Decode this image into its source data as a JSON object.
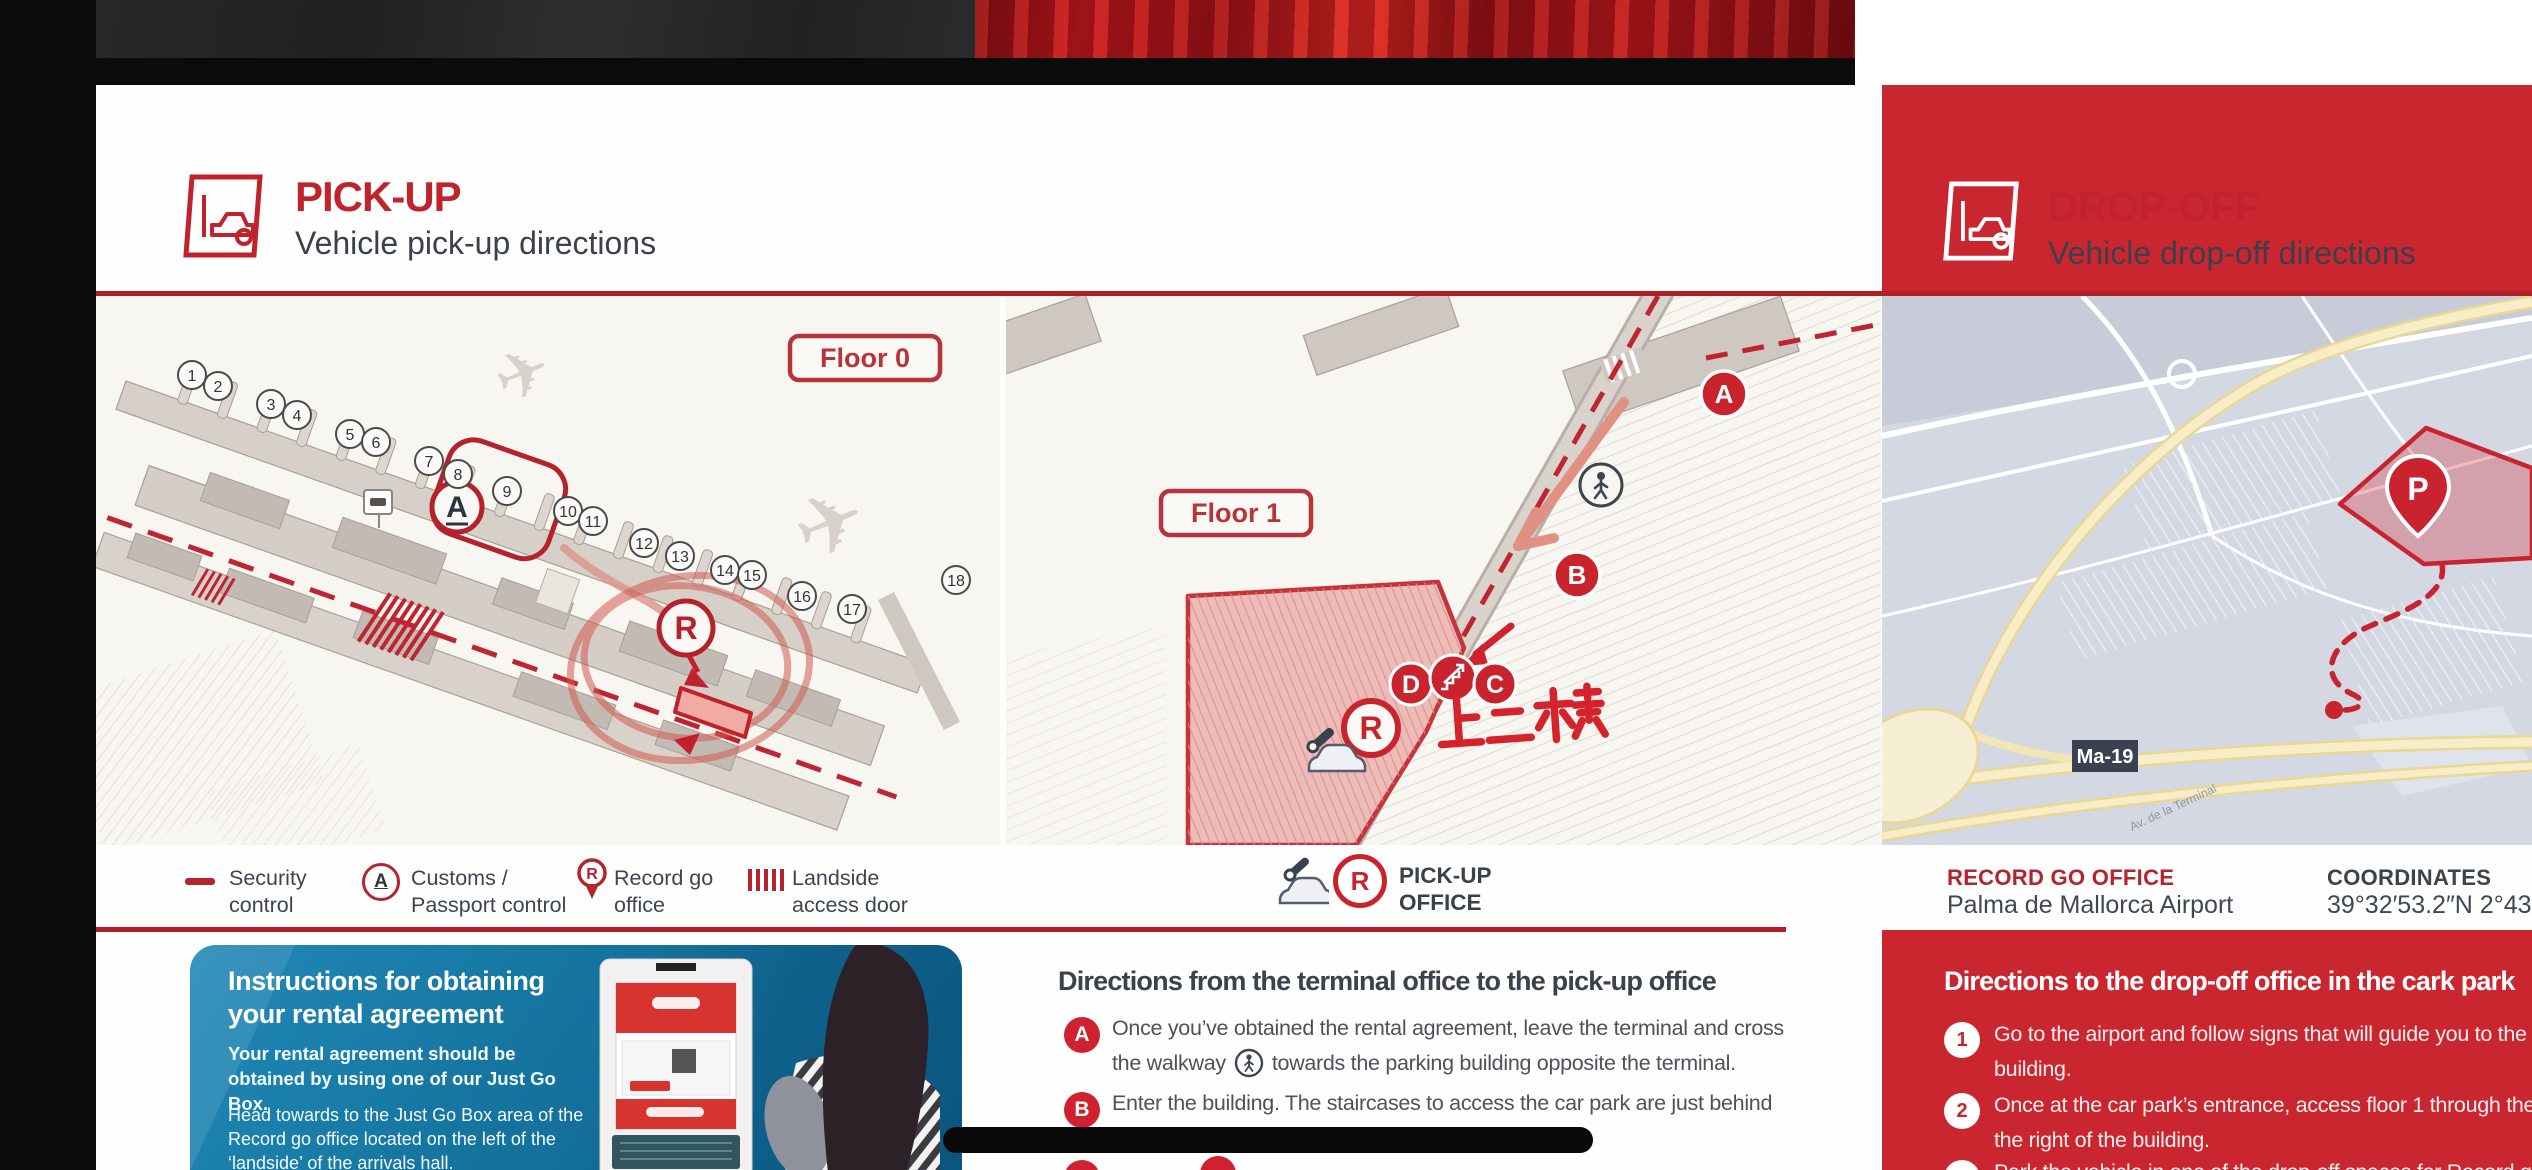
{
  "colors": {
    "brand_red": "#ca2630",
    "rule_red": "#ae1f26",
    "dark_text": "#3b424d",
    "legend_red": "#b5242c",
    "blue_box": "#15749f",
    "map_paper": "#f8f6f1",
    "street_map_bg": "#d4d8e2"
  },
  "pickup": {
    "header": {
      "title": "PICK-UP",
      "subtitle": "Vehicle pick-up directions"
    },
    "floor0": {
      "badge": "Floor 0",
      "gates": [
        "1",
        "2",
        "3",
        "4",
        "5",
        "6",
        "7",
        "8",
        "9",
        "10",
        "11",
        "12",
        "13",
        "14",
        "15",
        "16",
        "17",
        "18"
      ],
      "marker_a": "A",
      "marker_r": "R"
    },
    "floor1": {
      "badge": "Floor 1",
      "marker_a": "A",
      "marker_b": "B",
      "marker_c": "C",
      "marker_d": "D",
      "marker_r": "R",
      "note_cn": "上二楼"
    },
    "legend": [
      {
        "icon": "security-dash",
        "lines": [
          "Security",
          "control"
        ]
      },
      {
        "icon": "customs-a",
        "lines": [
          "Customs /",
          "Passport control"
        ]
      },
      {
        "icon": "record-pin",
        "lines": [
          "Record go",
          "office"
        ]
      },
      {
        "icon": "landside-hatch",
        "lines": [
          "Landside",
          "access door"
        ]
      }
    ],
    "office_legend": {
      "marker": "R",
      "lines": [
        "PICK-UP",
        "OFFICE"
      ]
    }
  },
  "dropoff": {
    "header": {
      "title": "DROP-OFF",
      "subtitle": "Vehicle drop-off directions"
    },
    "map": {
      "road_badge": "Ma-19",
      "parking_marker": "P",
      "road_label": "Av. de la Terminal"
    },
    "footer": {
      "office_label": "RECORD GO OFFICE",
      "office_value": "Palma de Mallorca Airport",
      "coords_label": "COORDINATES",
      "coords_value": "39°32′53.2″N 2°43′50."
    },
    "directions": {
      "title": "Directions to the drop-off office in the cark park",
      "steps": [
        {
          "n": "1",
          "lines": [
            "Go to the airport and follow signs that will guide you to the car park",
            "building."
          ]
        },
        {
          "n": "2",
          "lines": [
            "Once at the car park’s entrance, access floor 1 through the one-way ramp on",
            "the right of the building."
          ]
        },
        {
          "n": "3",
          "lines": [
            "Park the vehicle in one of the drop-off spaces for Record go"
          ]
        }
      ]
    }
  },
  "terminal_directions": {
    "title": "Directions from the terminal office to the pick-up office",
    "step_a": {
      "label": "A",
      "line1": "Once you’ve obtained the rental agreement, leave the terminal and cross",
      "line2_pre": "the walkway",
      "line2_post": "towards the parking building opposite the terminal."
    },
    "step_b": {
      "label": "B",
      "line1": "Enter the building. The staircases to access the car park are just behind",
      "line2": "the cafeteria."
    }
  },
  "instructions_box": {
    "title_line1": "Instructions for obtaining",
    "title_line2": "your rental agreement",
    "p1": "Your  rental agreement should be obtained by using one of our Just Go Box.",
    "p2": "Head towards to the Just Go Box area of the Record go office located on the left of the ‘landside’ of the arrivals hall."
  }
}
